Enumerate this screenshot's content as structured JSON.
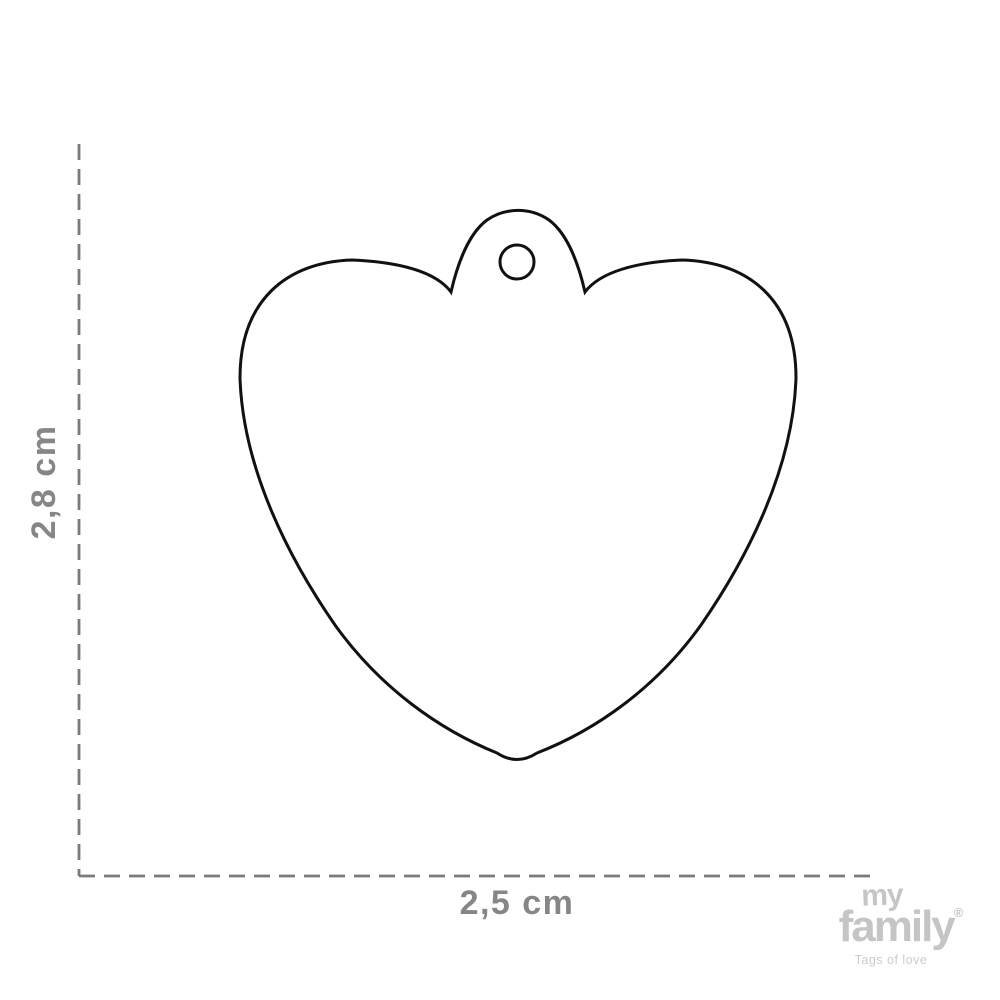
{
  "diagram": {
    "type": "product-dimension-drawing",
    "product": "heart-shaped-pet-id-tag",
    "height_label": "2,8 cm",
    "width_label": "2,5 cm",
    "outline_color": "#111111",
    "dimension_line_color": "#7b7b7b",
    "dimension_text_color": "#868686"
  },
  "logo": {
    "line1": "my",
    "line2": "family",
    "registered": "®",
    "tagline": "Tags of love",
    "color": "#c5c5c5"
  }
}
